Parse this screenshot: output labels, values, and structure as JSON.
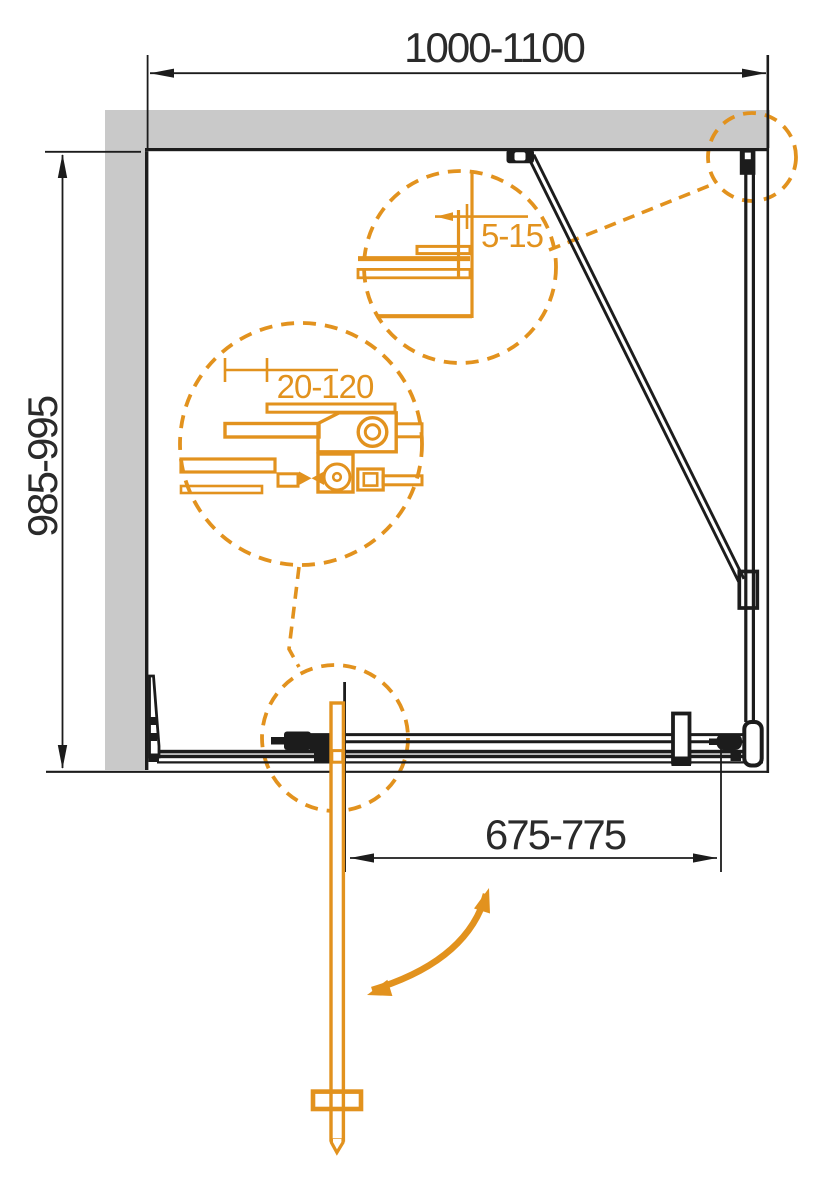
{
  "drawing": {
    "kind": "shower-enclosure-plan-technical-drawing",
    "colors": {
      "accent_orange": "#E2921E",
      "wall_gray": "#C9C9C9",
      "line_black": "#1C1C1C",
      "text_dark": "#2A2A2A"
    },
    "dimensions": {
      "overall_width": "1000-1100",
      "side_depth": "985-995",
      "door_width": "675-775",
      "wall_gap": "5-15",
      "adjustment": "20-120"
    }
  }
}
